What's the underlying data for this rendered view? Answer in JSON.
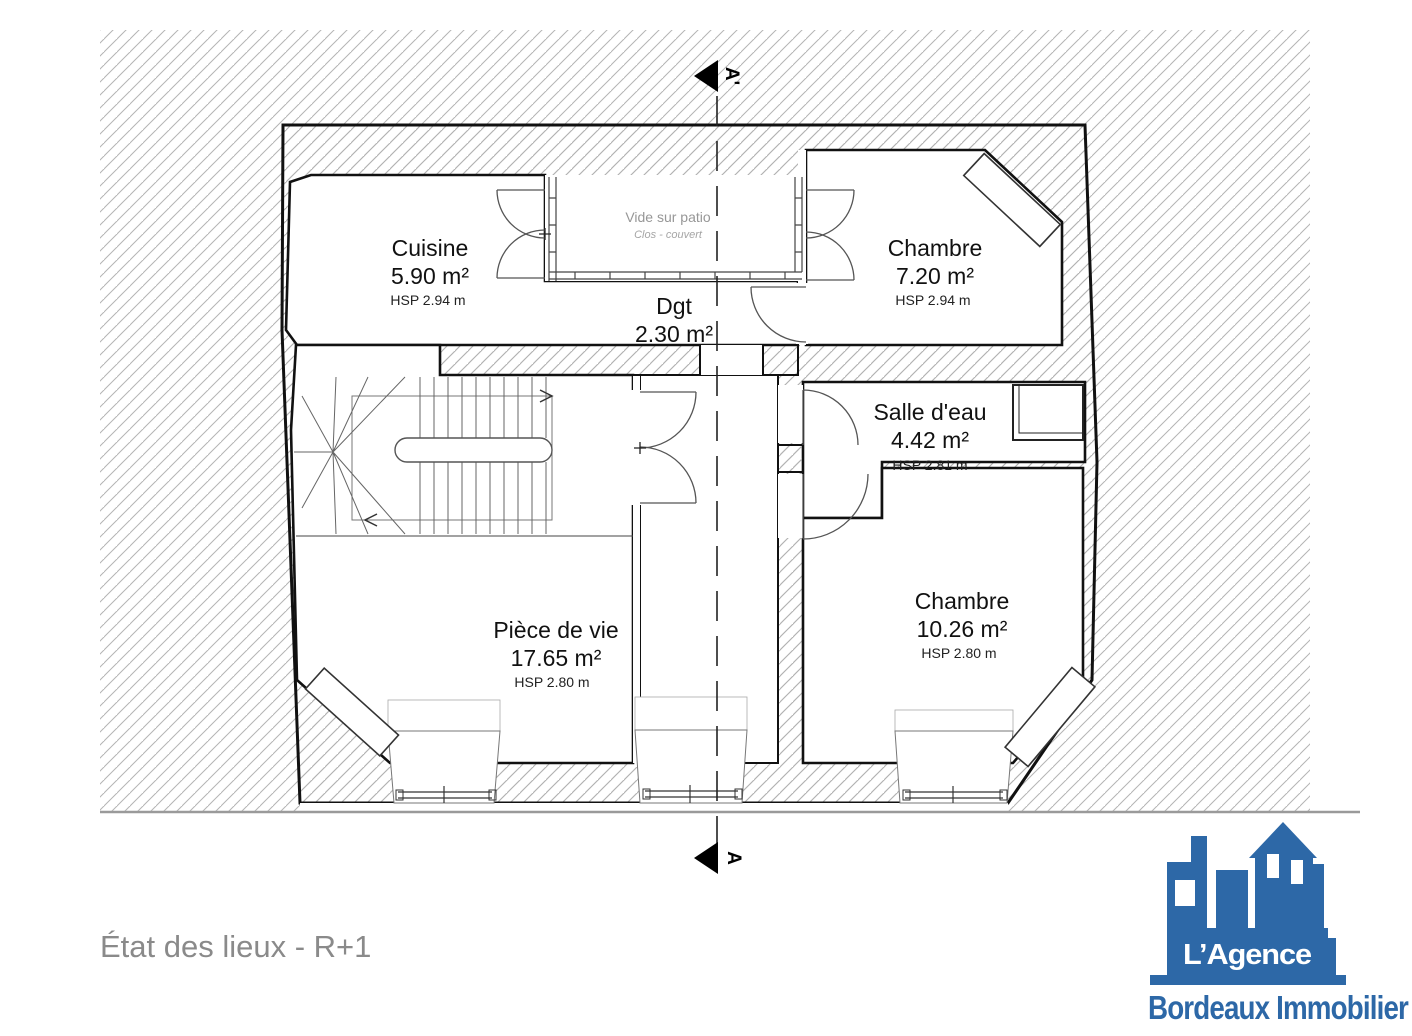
{
  "title": "État des lieux - R+1",
  "section": {
    "top_label": "A'",
    "bottom_label": "A"
  },
  "rooms": {
    "cuisine": {
      "name": "Cuisine",
      "area": "5.90 m²",
      "height": "HSP 2.94 m"
    },
    "chambre1": {
      "name": "Chambre",
      "area": "7.20 m²",
      "height": "HSP 2.94 m"
    },
    "dgt": {
      "name": "Dgt",
      "area": "2.30 m²"
    },
    "salle_eau": {
      "name": "Salle d'eau",
      "area": "4.42 m²",
      "height": "HSP 2.81 m"
    },
    "piece_de_vie": {
      "name": "Pièce de vie",
      "area": "17.65 m²",
      "height": "HSP 2.80 m"
    },
    "chambre2": {
      "name": "Chambre",
      "area": "10.26 m²",
      "height": "HSP 2.80 m"
    }
  },
  "patio": {
    "name": "Vide sur patio",
    "note": "Clos - couvert"
  },
  "logo": {
    "line1": "L’Agence",
    "line2": "Bordeaux Immobilier"
  },
  "colors": {
    "logo_blue": "#2d68a7",
    "title_gray": "#8a8a8a",
    "hatch_gray": "#b4b4b4",
    "wall_black": "#111111"
  }
}
